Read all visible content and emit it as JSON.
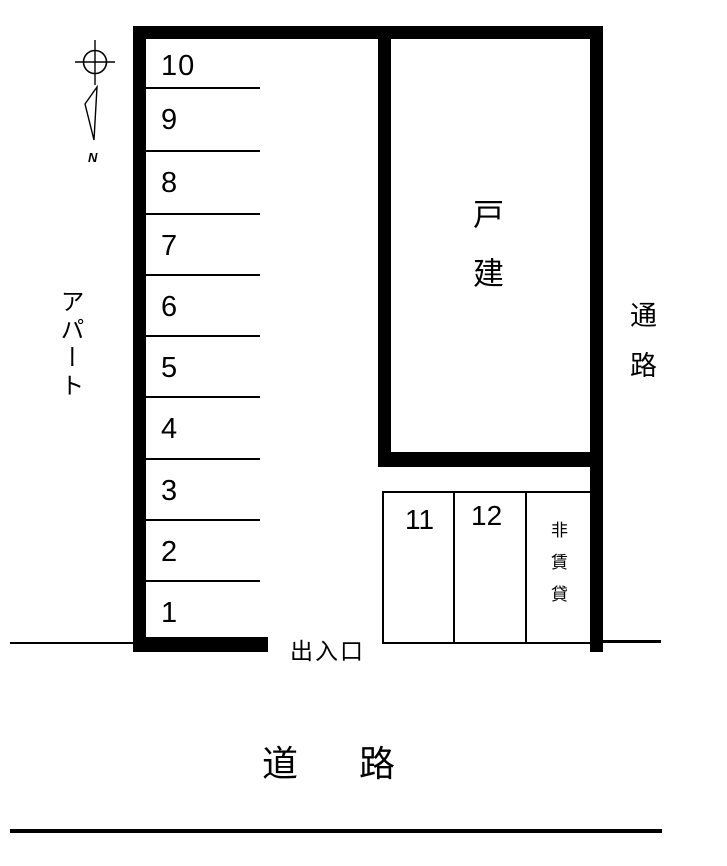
{
  "colors": {
    "ink": "#000000",
    "background": "#ffffff"
  },
  "diagram": {
    "compass": {
      "north_label": "N"
    },
    "apartment_label": "アパート",
    "parking_left_column": {
      "spaces": [
        "10",
        "9",
        "8",
        "7",
        "6",
        "5",
        "4",
        "3",
        "2",
        "1"
      ]
    },
    "house_plot": {
      "label": "戸建"
    },
    "passage_label": "通路",
    "bottom_parking": {
      "spaces": [
        "11",
        "12"
      ],
      "non_rental_label": "非賃貸"
    },
    "entrance_label": "出入口",
    "road_label": "道路"
  }
}
